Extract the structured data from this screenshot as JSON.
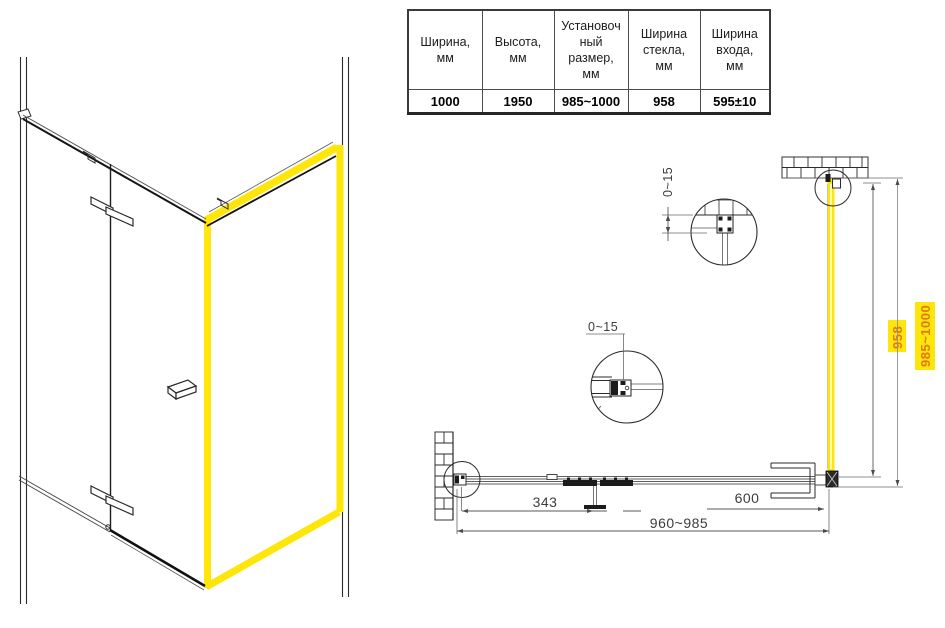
{
  "spec_table": {
    "columns": [
      {
        "header": "Ширина,\nмм",
        "value": "1000"
      },
      {
        "header": "Высота,\nмм",
        "value": "1950"
      },
      {
        "header": "Установоч\nный\nразмер,\nмм",
        "value": "985~1000"
      },
      {
        "header": "Ширина\nстекла,\nмм",
        "value": "958"
      },
      {
        "header": "Ширина\nвхода,\nмм",
        "value": "595±10"
      }
    ]
  },
  "plan_view": {
    "dim_top_adjust": "0~15",
    "dim_mid_adjust": "0~15",
    "dim_door_offset": "343",
    "dim_entry_width": "600",
    "dim_total_width": "960~985",
    "dim_glass_width": "958",
    "dim_install_width": "985~1000"
  },
  "colors": {
    "highlight_yellow": "#ffe60a",
    "dim_label_orange": "#e07818"
  }
}
